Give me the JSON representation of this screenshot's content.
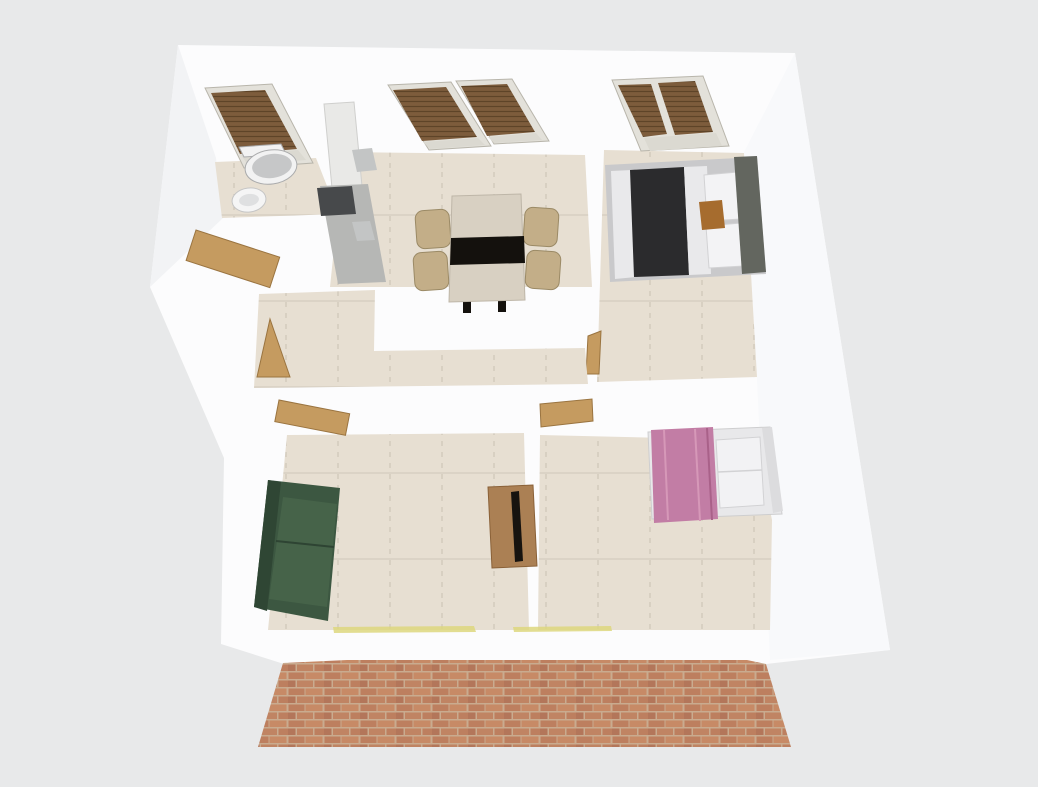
{
  "scene": {
    "type": "3d-floor-plan-render",
    "view": "aerial-perspective",
    "description": "Furnished apartment 3D floor plan viewed from above: bathroom and kitchen-dining at top left, bedroom with dark duvet at top right, central hallway with open tan doors, living room with green sofa and coffee table at bottom left, bedroom with pink duvet at bottom right, red brick front wall at the bottom, brown venetian blinds in all windows.",
    "background_color": "#e8e9ea"
  },
  "colors": {
    "background": "#e8e9ea",
    "wall_white": "#fcfcfd",
    "wall_shade": "#f2f3f5",
    "wall_shade_right": "#f8f9fb",
    "floor": "#e7dfd2",
    "tile_line": "#c9c1b3",
    "tile_line_h": "#cfc7ba",
    "window_frame": "#e3e1da",
    "window_glass": "#dbd9d1",
    "blinds_brown": "#7d5c3c",
    "blinds_slat": "#5e4428",
    "door_tan": "#c59b60",
    "cabinet_white": "#e9e9e7",
    "counter_gray": "#b6b7b5",
    "appliance_dark": "#47494b",
    "appliance_panel": "#c3c5c5",
    "table_top": "#d8d0c2",
    "table_runner": "#14110d",
    "chair_tan": "#c3ae88",
    "toilet_white": "#f2f2f2",
    "toilet_lid": "#c6c7c8",
    "sink_white": "#f5f5f5",
    "sink_basin": "#dfe0e1",
    "bed1_frame": "#c9c9cb",
    "bed1_duvet": "#2b2b2d",
    "bed1_sheet": "#e9e9eb",
    "bed1_pillow": "#f3f3f5",
    "bed1_headboard": "#63665f",
    "bed1_tray": "#a66c2e",
    "bed2_frame": "#e8e8ea",
    "bed2_headboard": "#dcdcde",
    "bed2_duvet_pink": "#c27da5",
    "bed2_fold": "#d698b8",
    "bed2_fold_dark": "#a96189",
    "bed2_pillow": "#f2f2f4",
    "sofa_green": "#3c5741",
    "sofa_back": "#2f4634",
    "sofa_seat": "#466349",
    "sofa_line": "#2e4433",
    "coffee_table": "#ab8054",
    "table_object_dark": "#17130f",
    "brick_mortar": "#c9ab8f",
    "brick_a": "#bd7f5f",
    "brick_b": "#c78a66",
    "brick_c": "#b3765a",
    "brick_d": "#c08463",
    "sill_yellow": "#ddd77e"
  },
  "rooms": [
    {
      "id": "bathroom",
      "position": "top-left",
      "windows": 1,
      "furniture": [
        "toilet",
        "washbasin"
      ]
    },
    {
      "id": "kitchen-dining",
      "position": "top-center",
      "windows": 2,
      "furniture": [
        "tall cabinet",
        "counter",
        "dark cooktop appliance",
        "dining table with black runner",
        "4 tan chairs"
      ]
    },
    {
      "id": "bedroom-1",
      "position": "top-right",
      "windows": 1,
      "furniture": [
        "double bed with dark duvet",
        "white pillows",
        "gray headboard",
        "wooden bed tray"
      ]
    },
    {
      "id": "hallway",
      "position": "center",
      "windows": 0,
      "furniture": [],
      "doors": [
        "entrance door",
        "open interior door",
        "bedroom-1 door"
      ]
    },
    {
      "id": "living-room",
      "position": "bottom-left",
      "windows": 0,
      "furniture": [
        "green sofa",
        "coffee table with dark object"
      ]
    },
    {
      "id": "bedroom-2",
      "position": "bottom-right",
      "windows": 0,
      "furniture": [
        "bed with pink duvet",
        "white pillows"
      ]
    }
  ],
  "exterior": {
    "front_wall": "red brick",
    "window_blinds": "brown venetian blinds",
    "sills": "yellow thresholds on front wall"
  }
}
